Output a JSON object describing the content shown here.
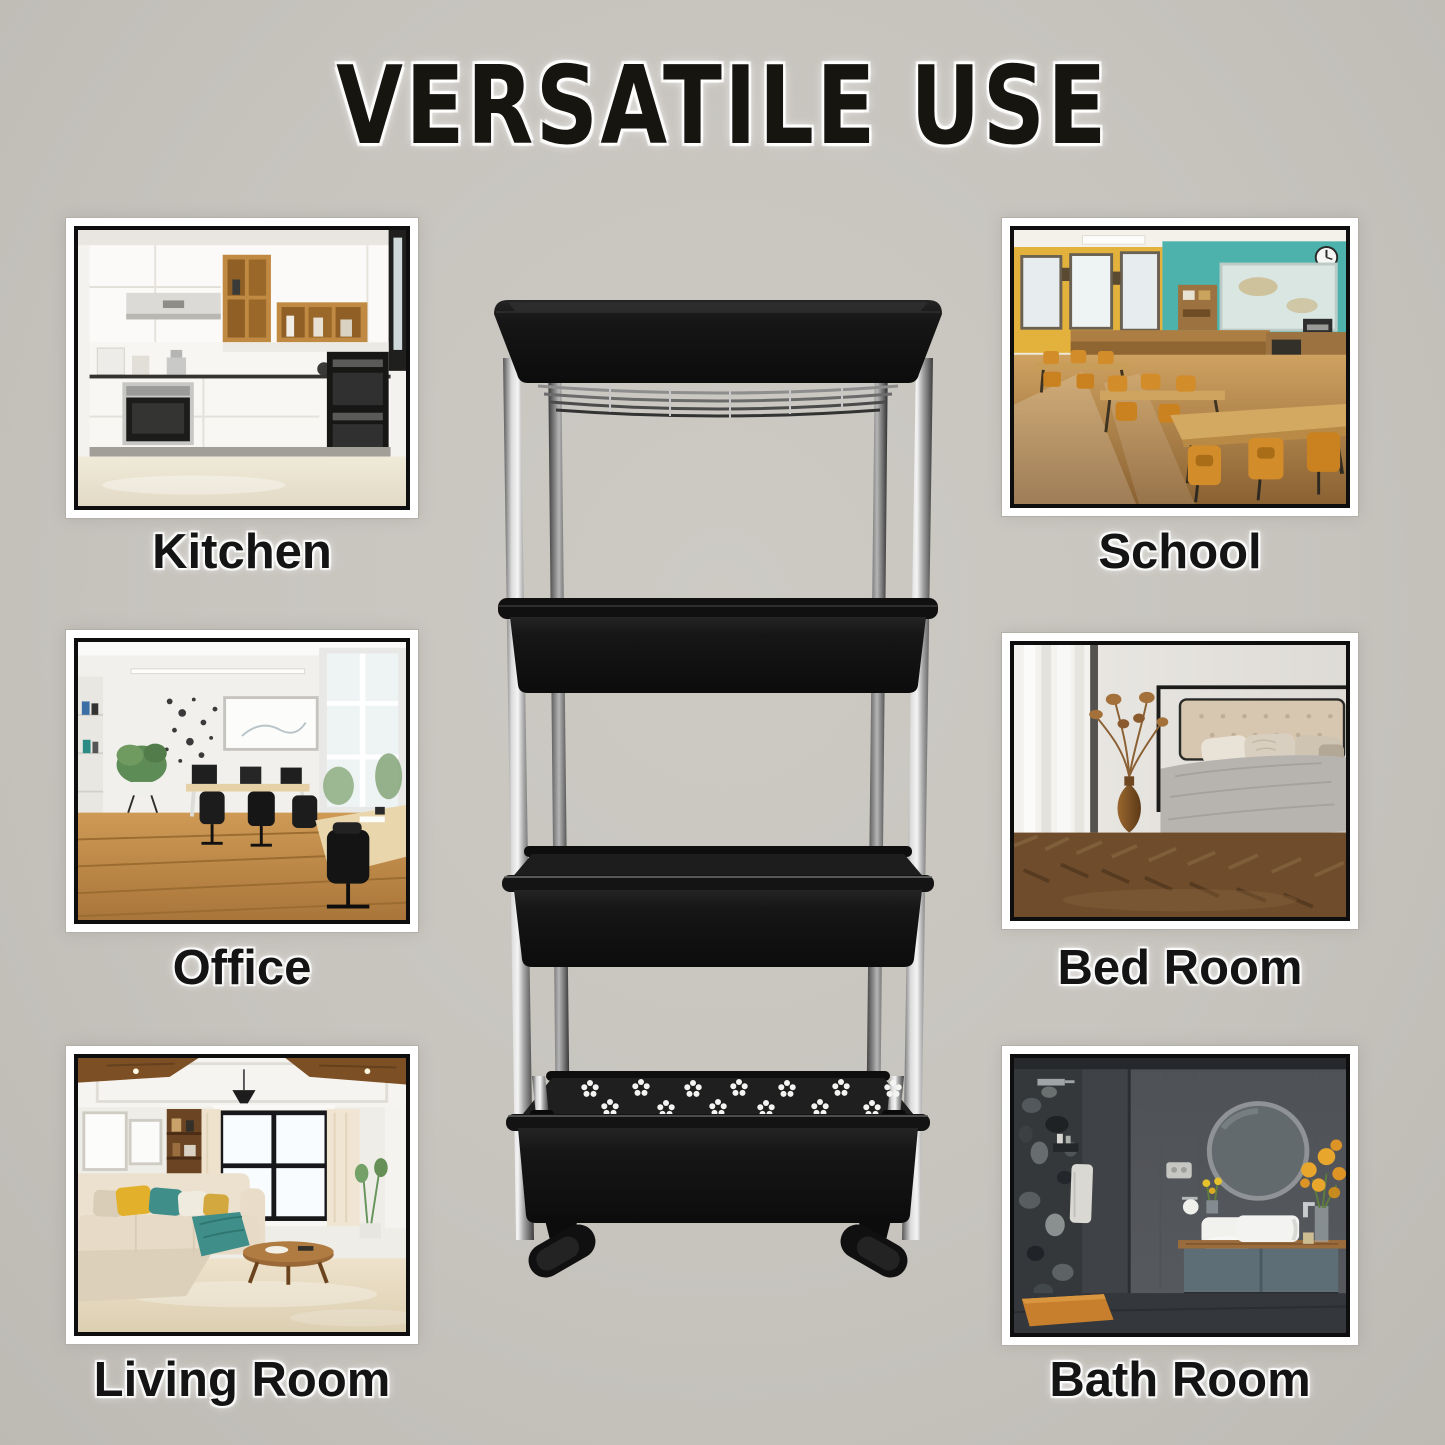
{
  "title": "VERSATILE USE",
  "rooms": [
    {
      "id": "kitchen",
      "label": "Kitchen"
    },
    {
      "id": "school",
      "label": "School"
    },
    {
      "id": "office",
      "label": "Office"
    },
    {
      "id": "bedroom",
      "label": "Bed Room"
    },
    {
      "id": "living_room",
      "label": "Living Room"
    },
    {
      "id": "bathroom",
      "label": "Bath Room"
    }
  ],
  "product": {
    "depicted": "black 4-tier slim rolling storage cart with chrome poles and caster wheels",
    "tiers": 4,
    "visible_wheels": 2
  },
  "colors": {
    "background": "#c7c4be",
    "title_text": "#17150f",
    "label_text": "#141414",
    "text_halo": "#ffffff",
    "frame_mat": "#ffffff",
    "frame_border": "#0e0e0e",
    "cart_plastic": "#141414",
    "cart_pole": "#c9c9c9"
  }
}
